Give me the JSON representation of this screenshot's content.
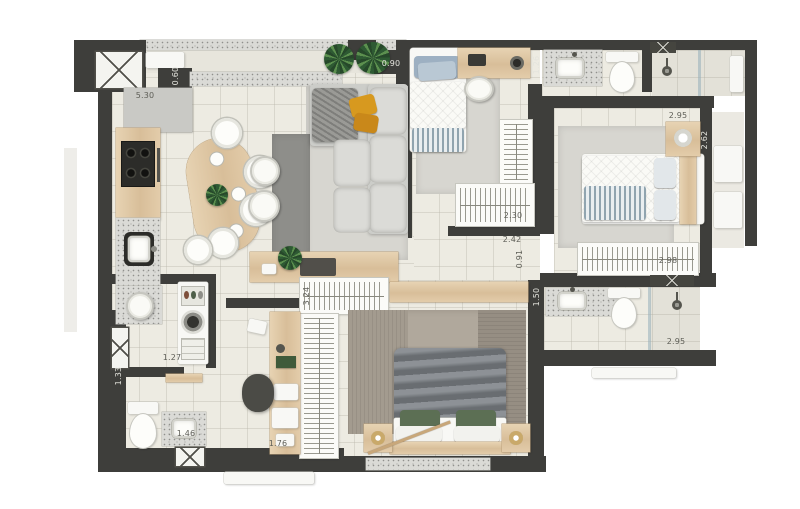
{
  "floorplan": {
    "kind": "apartment-floor-plan-top-view-render",
    "palette": {
      "wall": "#3e3e3b",
      "floor": "#edebe2",
      "granite": "#dadad6",
      "wood": "#ddc5a0",
      "rug_light": "#d7d6d0",
      "rug_dark": "#8e8e8a",
      "master_duvet": "#7d8287",
      "pillow_green": "#5c6f54",
      "pillow_mustard": "#d7991f",
      "pillow_blue": "#9db0c2",
      "plant_green": "#3c6b3f",
      "furniture_white": "#f8f8f5"
    },
    "dimensions": [
      {
        "id": "kitchen-run",
        "text": "5.30"
      },
      {
        "id": "counter-depth",
        "text": "0.60"
      },
      {
        "id": "balcony-edge",
        "text": "0.90"
      },
      {
        "id": "bath1-vanity-width",
        "text": "1.26"
      },
      {
        "id": "bath1-width",
        "text": "2.95"
      },
      {
        "id": "bedroom2-depth",
        "text": "2.62"
      },
      {
        "id": "closet1-width",
        "text": "2.30"
      },
      {
        "id": "hall-length",
        "text": "2.42"
      },
      {
        "id": "hall-width",
        "text": "0.91"
      },
      {
        "id": "closet2-width",
        "text": "2.98"
      },
      {
        "id": "bath2-vanity-width",
        "text": "1.50"
      },
      {
        "id": "bath2-width",
        "text": "2.95"
      },
      {
        "id": "master-closet-length",
        "text": "3.24"
      },
      {
        "id": "laundry-width",
        "text": "1.27"
      },
      {
        "id": "wc-width",
        "text": "1.33"
      },
      {
        "id": "wc-vanity-width",
        "text": "1.46"
      },
      {
        "id": "office-width",
        "text": "1.76"
      }
    ]
  }
}
